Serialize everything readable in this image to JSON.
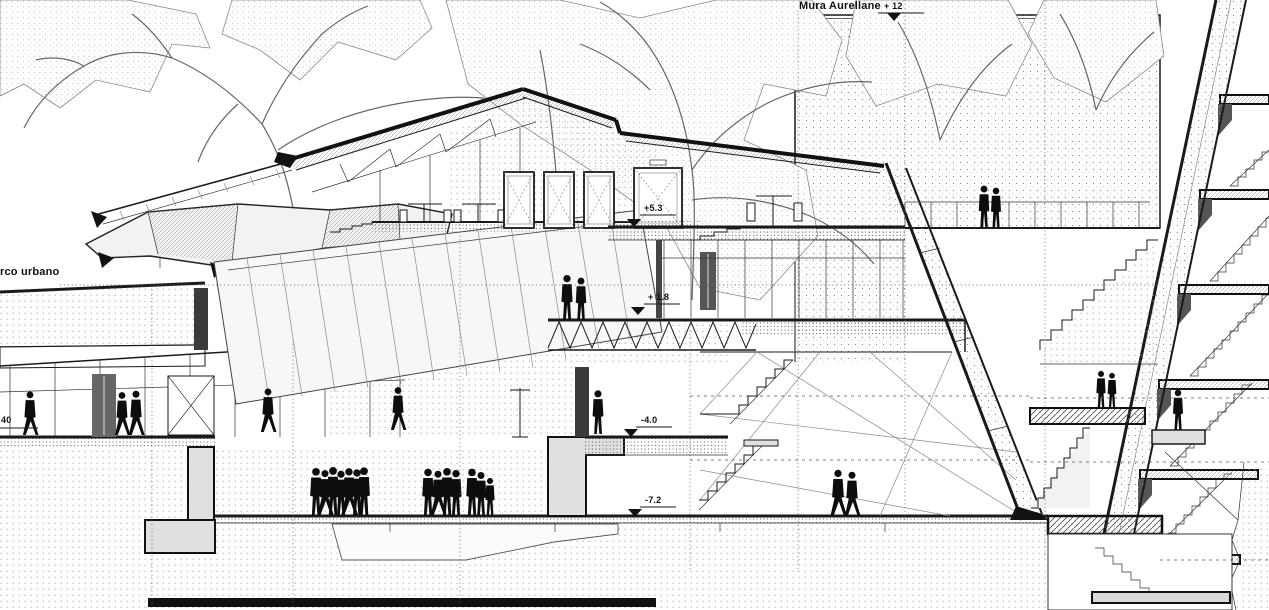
{
  "drawing": {
    "type": "architectural-section",
    "labels": {
      "wall_title": "Mura Aurellane",
      "park": "rco urbano",
      "left_elevation": "40"
    },
    "elevations": {
      "wall_top": "+ 12",
      "upper_terrace": "+5.3",
      "mid_terrace": "+ 1.8",
      "gallery_level": "-4.0",
      "plaza_level": "-7.2"
    },
    "colors": {
      "ink": "#1a1a1a",
      "paper": "#ffffff",
      "stipple": "#9a9a9a",
      "figure": "#0d0d0d"
    }
  }
}
